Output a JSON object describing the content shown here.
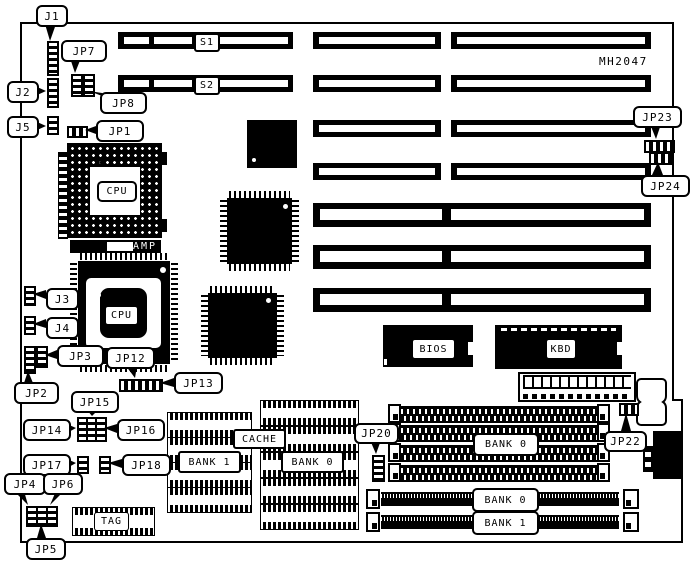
{
  "board": {
    "id_text": "MH2047"
  },
  "callouts": {
    "j1": "J1",
    "j2": "J2",
    "j3": "J3",
    "j4": "J4",
    "j5": "J5",
    "jp1": "JP1",
    "jp2": "JP2",
    "jp3": "JP3",
    "jp4": "JP4",
    "jp5": "JP5",
    "jp6": "JP6",
    "jp7": "JP7",
    "jp8": "JP8",
    "jp12": "JP12",
    "jp13": "JP13",
    "jp14": "JP14",
    "jp15": "JP15",
    "jp16": "JP16",
    "jp17": "JP17",
    "jp18": "JP18",
    "jp20": "JP20",
    "jp22": "JP22",
    "jp23": "JP23",
    "jp24": "JP24"
  },
  "slots": {
    "s1": "S1",
    "s2": "S2"
  },
  "components": {
    "cpu_socket": "CPU",
    "cpu_chip": "CPU",
    "amp": "AMP",
    "bios": "BIOS",
    "keyboard_controller": "KBD",
    "tag": "TAG",
    "cache": "CACHE"
  },
  "memory": {
    "cache_bank1": "BANK 1",
    "cache_bank0": "BANK 0",
    "simm30_bank0": "BANK 0",
    "simm72_bank0": "BANK 0",
    "simm72_bank1": "BANK 1"
  }
}
